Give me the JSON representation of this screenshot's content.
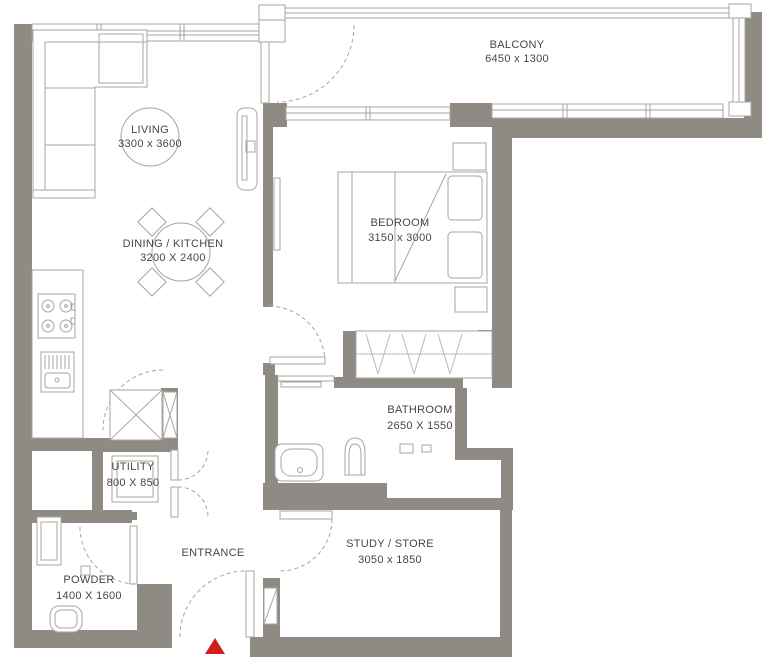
{
  "plan": {
    "rooms": {
      "living": {
        "name": "LIVING",
        "dims": "3300 x 3600"
      },
      "dining_kitchen": {
        "name": "DINING / KITCHEN",
        "dims": "3200 X 2400"
      },
      "bedroom": {
        "name": "BEDROOM",
        "dims": "3150 x 3000"
      },
      "balcony": {
        "name": "BALCONY",
        "dims": "6450 x 1300"
      },
      "bathroom": {
        "name": "BATHROOM",
        "dims": "2650 X 1550"
      },
      "utility": {
        "name": "UTILITY",
        "dims": "800 X 850"
      },
      "powder": {
        "name": "POWDER",
        "dims": "1400 X 1600"
      },
      "entrance": {
        "name": "ENTRANCE"
      },
      "study_store": {
        "name": "STUDY / STORE",
        "dims": "3050 x 1850"
      }
    },
    "colors": {
      "wall": "#8f8a84",
      "line": "#a8a5a0",
      "hatch": "#bcb9b4",
      "text": "#48463f",
      "marker": "#cf1f1b"
    }
  }
}
